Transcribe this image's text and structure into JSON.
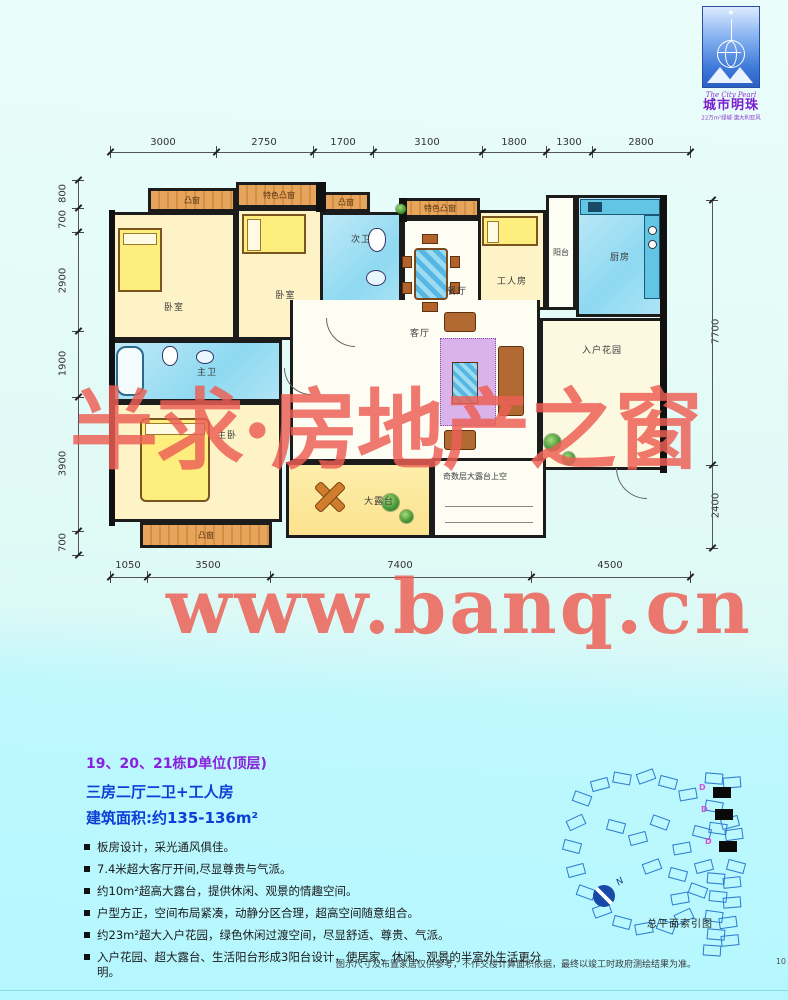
{
  "logo": {
    "name_en": "The City Pearl",
    "name_cn": "城市明珠",
    "tagline": "22万m²绿城·澳大利亚风",
    "star_icon": "★"
  },
  "watermark": {
    "line1": "半求·房地产之窗",
    "line2": "www.banq.cn"
  },
  "floorplan": {
    "dims_top": [
      "3000",
      "2750",
      "1700",
      "3100",
      "1800",
      "1300",
      "2800"
    ],
    "dims_left": [
      "800",
      "700",
      "2900",
      "1900",
      "3900",
      "700"
    ],
    "dims_right": [
      "7700",
      "2400"
    ],
    "dims_bottom": [
      "1050",
      "3500",
      "7400",
      "4500"
    ],
    "rooms": {
      "bay_window_1": "凸窗",
      "bedroom_1": "卧室",
      "feature_bay_1": "特色凸窗",
      "bedroom_2": "卧室",
      "bay_window_2": "凸窗",
      "bath_2": "次卫",
      "feature_bay_2": "特色凸窗",
      "dining": "餐厅",
      "worker_room": "工人房",
      "balcony": "阳台",
      "kitchen": "厨房",
      "master_bath": "主卫",
      "master_bedroom": "主卧",
      "bay_window_3": "凸窗",
      "living": "客厅",
      "entry_garden": "入户花园",
      "terrace": "大露台",
      "open_above": "奇数层大露台上空"
    }
  },
  "info": {
    "title": "19、20、21栋D单位(顶层)",
    "subtitle": "三房二厅二卫+工人房",
    "area": "建筑面积:约135-136m²",
    "bullets": [
      "板房设计，采光通风俱佳。",
      "7.4米超大客厅开间,尽显尊贵与气派。",
      "约10m²超高大露台，提供休闲、观景的情趣空间。",
      "户型方正，空间布局紧凑，动静分区合理，超高空间随意组合。",
      "约23m²超大入户花园，绿色休闲过渡空间，尽显舒适、尊贵、气派。",
      "入户花园、超大露台、生活阳台形成3阳台设计，使居家、休闲、观景的半室外生活更分明。"
    ]
  },
  "siteplan": {
    "caption": "总平面索引图",
    "unit_label": "D",
    "north": "N"
  },
  "footer": {
    "disclaimer": "图示尺寸及布置家居仅供参考，不作交楼计算面积依据，最终以竣工时政府测绘结果为准。",
    "page_number": "10"
  }
}
